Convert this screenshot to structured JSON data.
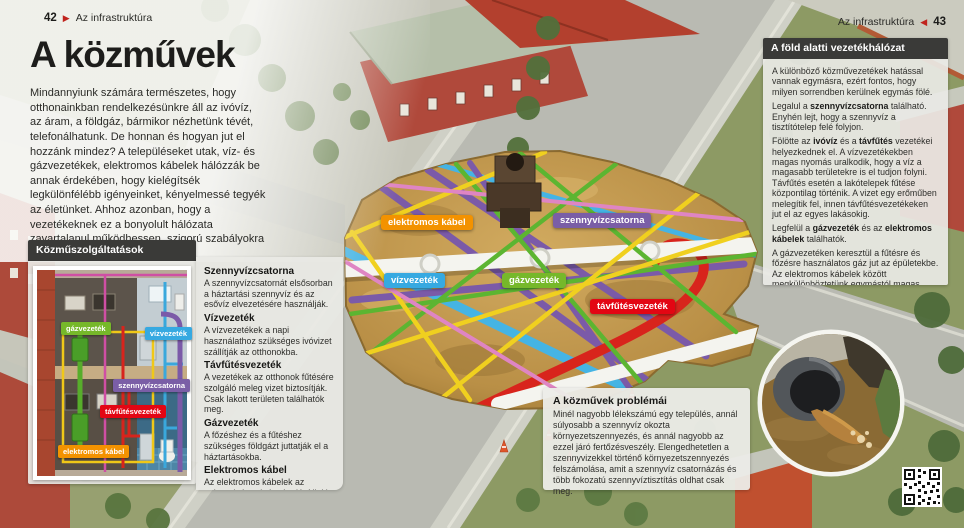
{
  "left_header": {
    "page": "42",
    "arrow": "▶",
    "section": "Az infrastruktúra"
  },
  "right_header": {
    "section": "Az infrastruktúra",
    "arrow": "◀",
    "page": "43"
  },
  "title": "A közművek",
  "intro": "Mindannyiunk számára természetes, hogy otthonainkban rendelkezésünkre áll az ivóvíz, az áram, a földgáz, bármikor nézhetünk tévét, telefonálhatunk. De honnan és hogyan jut el hozzánk mindez? A településeket utak, víz- és gázvezetékek, elektromos kábelek hálózzák be annak érdekében, hogy kielégítsék legkülönfélébb igényeinket, kényelmessé tegyék az életünket. Ahhoz azonban, hogy a vezetékeknek ez a bonyolult hálózata zavartalanul működhessen, szigorú szabályokra van szükség.",
  "pipes": [
    {
      "name": "gázvezeték",
      "color": "#76b82a"
    },
    {
      "name": "vízvezeték",
      "color": "#36a9e1"
    },
    {
      "name": "szennyvízcsatorna",
      "color": "#7a5ea6"
    },
    {
      "name": "távfűtésvezeték",
      "color": "#e30613"
    },
    {
      "name": "elektromos kábel",
      "color": "#f39200"
    }
  ],
  "services_box": {
    "title": "Közműszolgáltatások"
  },
  "definitions": [
    {
      "term": "Szennyvízcsatorna",
      "text": "A szennyvízcsatornát elsősorban a háztartási szennyvíz és az esővíz elvezetésére használják."
    },
    {
      "term": "Vízvezeték",
      "text": "A vízvezetékek a napi használathoz szükséges ivóvizet szállítják az otthonokba."
    },
    {
      "term": "Távfűtésvezeték",
      "text": "A vezetékek az otthonok fűtésére szolgáló meleg vizet biztosítják. Csak lakott területen találhatók meg."
    },
    {
      "term": "Gázvezeték",
      "text": "A főzéshez és a fűtéshez szükséges földgázt juttatják el a háztartásokba."
    },
    {
      "term": "Elektromos kábel",
      "text": "Az elektromos kábelek az otthonok áramigényét elégítik ki, valamint bekapcsolják az épületeket a távközlési hálózatokba."
    }
  ],
  "underground_box": {
    "title": "A föld alatti vezetékhálózat",
    "paragraphs": [
      [
        {
          "t": "A különböző közművezetékek hatással vannak egymásra, ezért fontos, hogy milyen sorrendben kerülnek egymás fölé."
        }
      ],
      [
        {
          "t": "Legalul a "
        },
        {
          "t": "szennyvízcsatorna",
          "b": true
        },
        {
          "t": " található. Enyhén lejt, hogy a szennyvíz a tisztítótelep felé folyjon."
        }
      ],
      [
        {
          "t": "Fölötte az "
        },
        {
          "t": "ivóvíz",
          "b": true
        },
        {
          "t": " és a "
        },
        {
          "t": "távfűtés",
          "b": true
        },
        {
          "t": " vezetékei helyezkednek el. A vízvezetékekben magas nyomás uralkodik, hogy a víz a magasabb területekre is el tudjon folyni. Távfűtés esetén a lakótelepek fűtése központilag történik. A vizet egy erőműben melegítik fel, innen távfűtésvezetékeken jut el az egyes lakásokig."
        }
      ],
      [
        {
          "t": "Legfelül a "
        },
        {
          "t": "gázvezeték",
          "b": true
        },
        {
          "t": " és az "
        },
        {
          "t": "elektromos kábelek",
          "b": true
        },
        {
          "t": " találhatók."
        }
      ],
      [
        {
          "t": "A gázvezetéken keresztül a fűtésre és főzésre használatos gáz jut az épületekbe. Az elektromos kábelek között megkülönböztetünk egymástól magas, közép- és alacsony feszültségű elektromos vezetékeket, továbbá távközlési kábeleket."
        }
      ]
    ]
  },
  "problems_box": {
    "title": "A közművek problémái",
    "text": "Minél nagyobb lélekszámú egy település, annál súlyosabb a szennyvíz okozta környezetszennyezés, és annál nagyobb az ezzel járó fertőzésveszély. Elengedhetetlen a szennyvizekkel történő környezetszennyezés felszámolása, amit a szennyvíz csatornázás és több fokozatú szennyvíztisztítás oldhat csak meg."
  },
  "colors": {
    "header_bar": "#3a3a38",
    "panel_bg": "#e9e9e5",
    "arrow_red": "#c0231d"
  }
}
